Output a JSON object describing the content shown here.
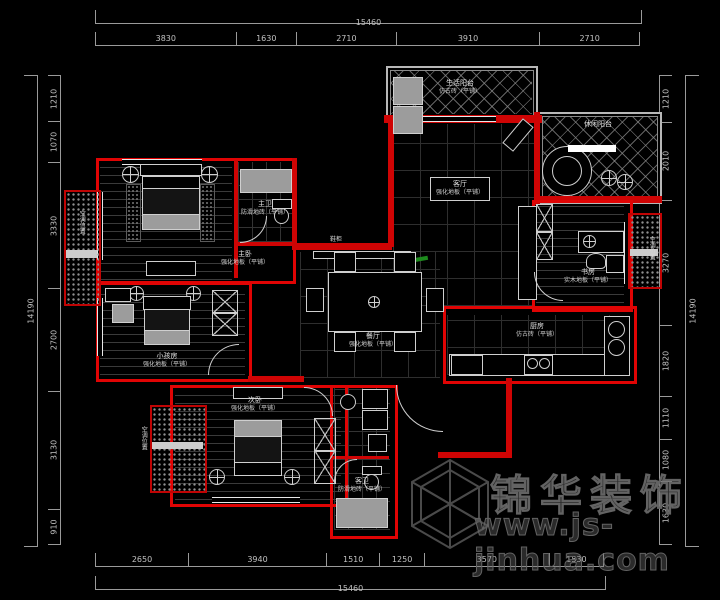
{
  "watermark": {
    "brand": "锦华装饰",
    "url": "www.js-jinhua.com"
  },
  "rooms": {
    "living_balcony": {
      "name": "生活阳台",
      "floor": "仿古砖（平铺）"
    },
    "leisure_balcony": {
      "name": "休闲阳台",
      "floor": "仿古砖（平铺）"
    },
    "living": {
      "name": "客厅",
      "floor": "强化地板（平铺）"
    },
    "dining": {
      "name": "餐厅",
      "floor": "强化地板（平铺）"
    },
    "master_bed": {
      "name": "主卧",
      "floor": "强化地板（平铺）"
    },
    "master_bath": {
      "name": "主卫",
      "floor": "防滑地砖（平铺）"
    },
    "kids": {
      "name": "小孩房",
      "floor": "强化地板（平铺）"
    },
    "study": {
      "name": "书房",
      "floor": "实木地板（平铺）"
    },
    "kitchen": {
      "name": "厨房",
      "floor": "仿古砖（平铺）"
    },
    "guest_bed": {
      "name": "次卧",
      "floor": "强化地板（平铺）"
    },
    "guest_bath": {
      "name": "客卫",
      "floor": "防滑地砖（平铺）"
    }
  },
  "labels": {
    "cabinet": "鞋柜",
    "ac": "空调位置"
  },
  "dims": {
    "top": {
      "total": "15460",
      "segments": [
        "3830",
        "1630",
        "2710",
        "3910",
        "2710"
      ]
    },
    "bottom": {
      "total": "15460",
      "segments": [
        "2650",
        "3940",
        "1510",
        "1250",
        "3570",
        "1530"
      ]
    },
    "left": {
      "total": "14190",
      "segments": [
        "1210",
        "1070",
        "3330",
        "2700",
        "3130",
        "910"
      ]
    },
    "right": {
      "total": "14190",
      "segments": [
        "1210",
        "2010",
        "3270",
        "1820",
        "1110",
        "1080",
        "1630"
      ]
    }
  },
  "colors": {
    "wall": "#e00404",
    "line": "#cfcfcf",
    "dim_text": "#c2c2c2",
    "watermark": "#636363",
    "accent_green": "#1d8a1d"
  }
}
